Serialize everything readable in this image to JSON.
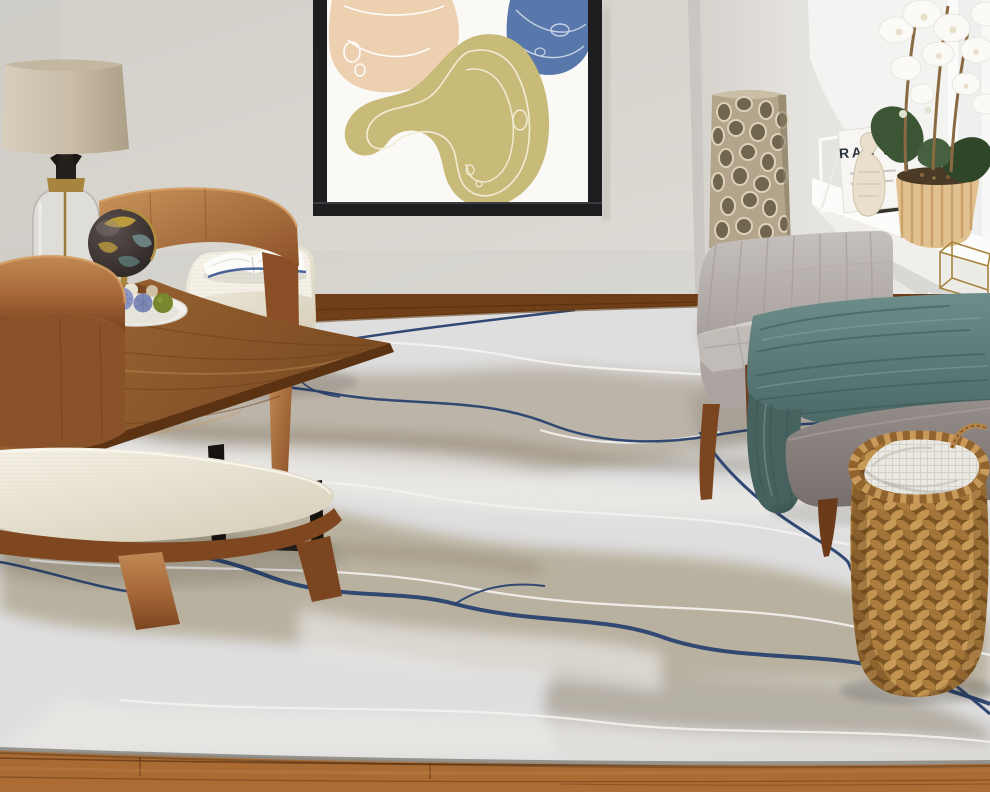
{
  "meta": {
    "image_type": "interior photograph",
    "subject": "living room staged with abstract marble area rug"
  },
  "windowsill": {
    "book_text": "RAN SY",
    "items": [
      "white-metal-bookend",
      "cookbook",
      "dark-books",
      "carved-cream-figurine",
      "woven-planter-with-orchid",
      "brass-glass-terrarium"
    ]
  },
  "wall_art": {
    "frame_color": "#1e1e20",
    "canvas_color": "#fbf9f5",
    "blobs": [
      {
        "name": "tan-blob",
        "color": "#ecd0b0"
      },
      {
        "name": "olive-blob",
        "color": "#c8ba79"
      },
      {
        "name": "blue-blob",
        "color": "#5878ac"
      }
    ]
  },
  "rug": {
    "style": "abstract marble / watercolor",
    "base_color": "#e2e2e3",
    "taupe_color": "#a69a83",
    "vein_color": "#2b4470",
    "contour_color": "#f8f7f3"
  },
  "furniture": [
    {
      "name": "table-lamp",
      "desc": "drum linen shade, seeded glass cylinder base, brass cap",
      "colors": [
        "#cdc2ae",
        "#e0dfda",
        "#a8853e"
      ]
    },
    {
      "name": "walnut-chair-front",
      "desc": "curved-back walnut slipper chair with cream cushion",
      "colors": [
        "#a8693a",
        "#f2eee2"
      ]
    },
    {
      "name": "walnut-chair-back",
      "desc": "second curved walnut chair back",
      "colors": [
        "#a8693a"
      ]
    },
    {
      "name": "ottoman-bench",
      "desc": "cream upholstered bench with open book on top",
      "colors": [
        "#f2eee2"
      ]
    },
    {
      "name": "side-table",
      "desc": "rustic wood top with black metal legs, holds globe and decor plate",
      "colors": [
        "#9a6434",
        "#17130f"
      ]
    },
    {
      "name": "globe",
      "desc": "dark vintage desk globe with brass stand",
      "colors": [
        "#3c3432",
        "#c8a43c",
        "#6f8a88"
      ]
    },
    {
      "name": "decor-plate",
      "desc": "white plate with blue thistle balls, moss ball and shells",
      "colors": [
        "#f2f0ea",
        "#8e97c2",
        "#77862f"
      ]
    },
    {
      "name": "chaise-sofa",
      "desc": "light gray biscuit-tufted armless chaise on splayed walnut legs",
      "colors": [
        "#bfb9b6"
      ]
    },
    {
      "name": "throw-blanket",
      "desc": "teal chunky cable-knit throw draped on chaise",
      "colors": [
        "#5a7c7a"
      ]
    },
    {
      "name": "armchair-foreground",
      "desc": "darker gray upholstered arm, walnut tapered leg",
      "colors": [
        "#8d8582"
      ]
    },
    {
      "name": "floor-vase",
      "desc": "tall champagne openwork coral-pattern floor vase",
      "colors": [
        "#b3a48b"
      ]
    },
    {
      "name": "woven-basket",
      "desc": "water-hyacinth basket holding white waffle-knit blanket",
      "colors": [
        "#c2965a",
        "#eae8e2"
      ]
    }
  ],
  "room": {
    "wall_color": "#d9d6d0",
    "right_wall_color": "#e4e2de",
    "floor_color": "#8a5122",
    "window_light": "#f6f6f4"
  }
}
